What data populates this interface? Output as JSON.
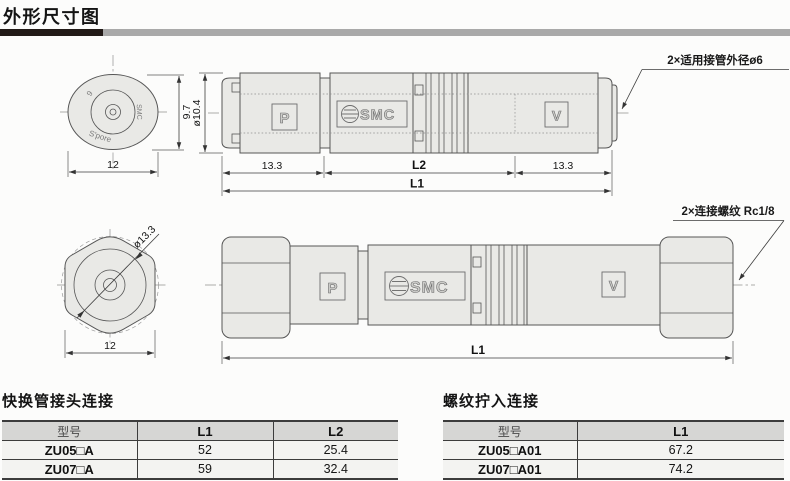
{
  "page": {
    "title": "外形尺寸图",
    "bar_black": "#221a17",
    "bar_gray": "#a9a9a9"
  },
  "drawing": {
    "marks": {
      "p": "P",
      "v": "V",
      "smc": "SMC",
      "cap_size": "6",
      "cap_brand": "SMC",
      "cap_origin": "S'pore"
    },
    "top_view": {
      "body_dia": "ø10.4",
      "cap_height": "9.7",
      "cap_width": "12",
      "seg_left": "13.3",
      "seg_mid": "L2",
      "seg_right": "13.3",
      "total": "L1",
      "note": "2×适用接管外径ø6"
    },
    "bottom_view": {
      "hex_dia": "ø13.3",
      "hex_width": "12",
      "total": "L1",
      "note": "2×连接螺纹 Rc1/8"
    }
  },
  "tables": [
    {
      "title": "快换管接头连接",
      "headers": [
        "型号",
        "L1",
        "L2"
      ],
      "rows": [
        [
          "ZU05□A",
          "52",
          "25.4"
        ],
        [
          "ZU07□A",
          "59",
          "32.4"
        ]
      ]
    },
    {
      "title": "螺纹拧入连接",
      "headers": [
        "型号",
        "L1"
      ],
      "rows": [
        [
          "ZU05□A01",
          "67.2"
        ],
        [
          "ZU07□A01",
          "74.2"
        ]
      ]
    }
  ]
}
